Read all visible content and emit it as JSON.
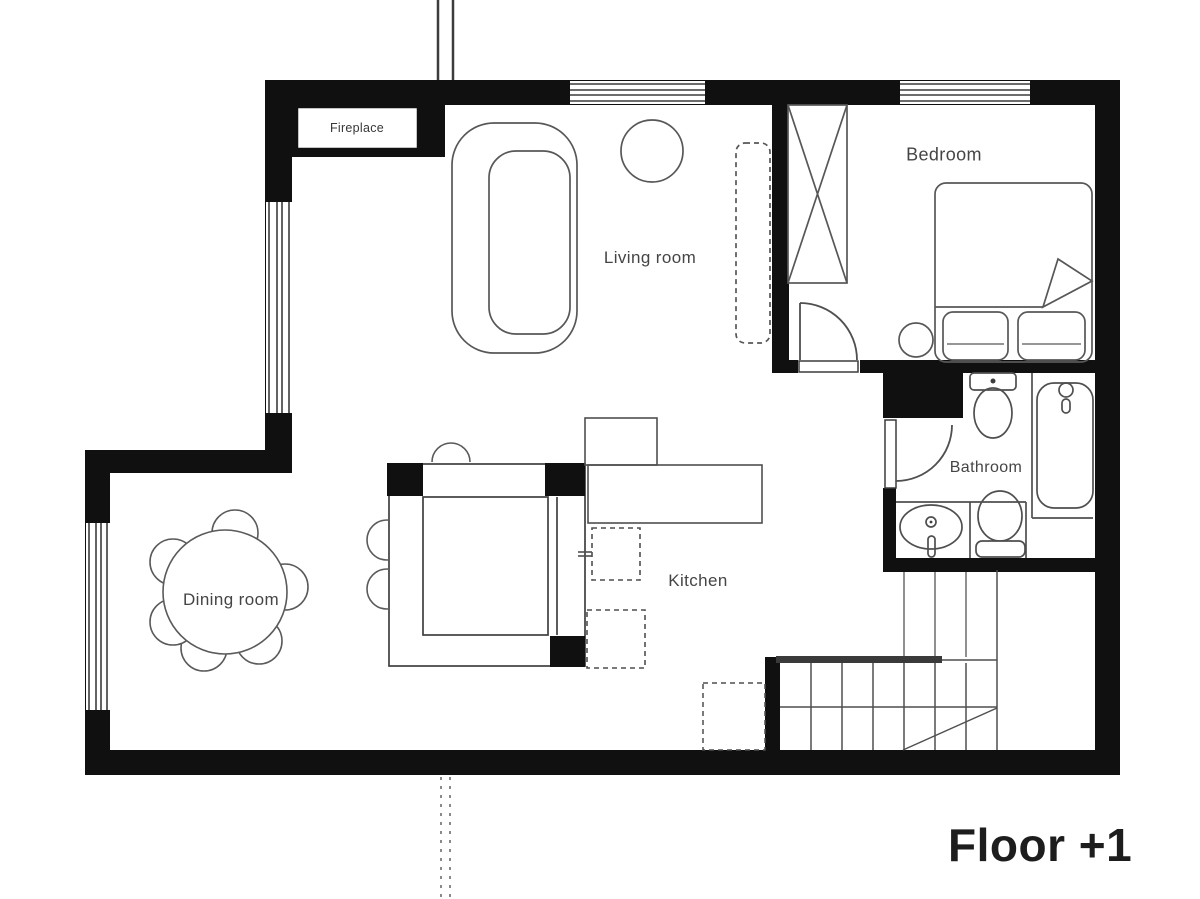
{
  "floor_title": "Floor +1",
  "labels": {
    "fireplace": "Fireplace",
    "living_room": "Living room",
    "bedroom": "Bedroom",
    "bathroom": "Bathroom",
    "kitchen": "Kitchen",
    "dining_room": "Dining room"
  },
  "colors": {
    "wall": "#101010",
    "line": "#4f4f4f",
    "label_text": "#454545",
    "floor_title_text": "#1d1d1d",
    "background": "#ffffff"
  }
}
